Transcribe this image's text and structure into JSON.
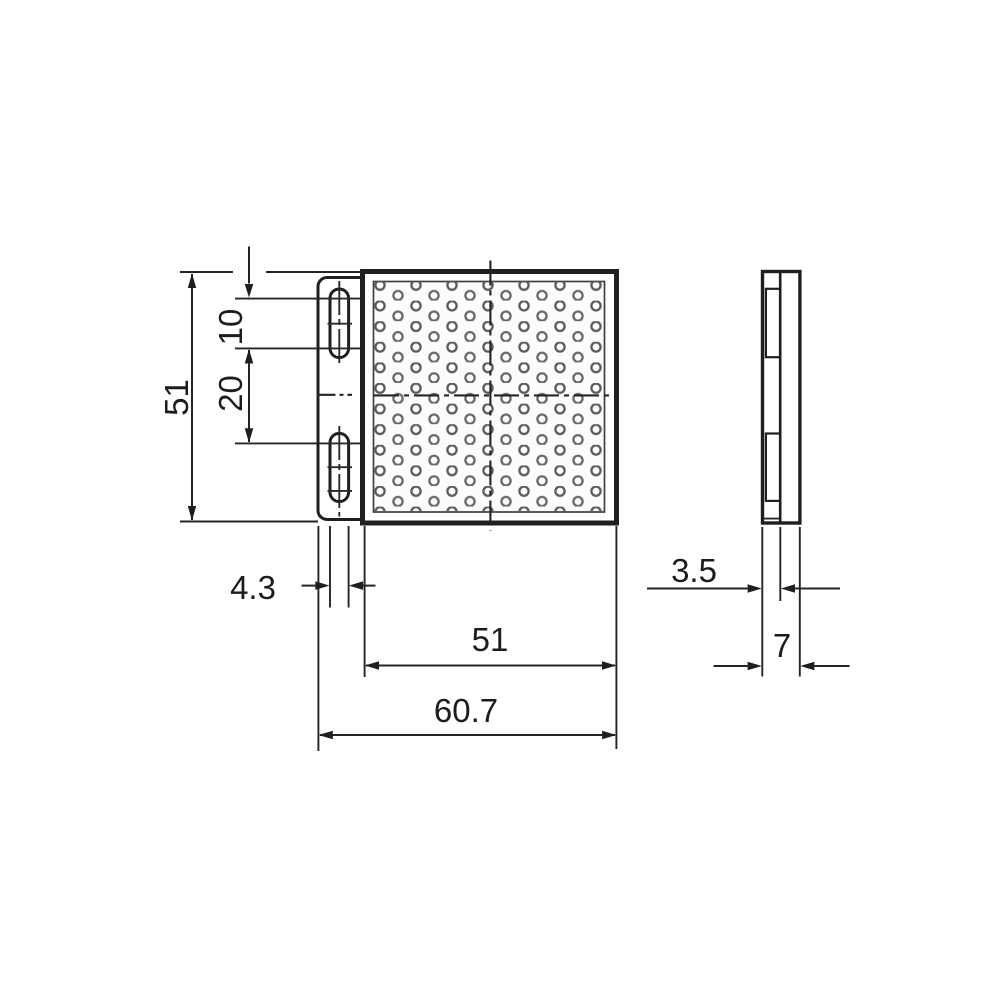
{
  "drawing": {
    "kind": "technical-dimension-drawing",
    "views": {
      "front": "front-view-reflector-with-bracket",
      "side": "side-profile-view"
    }
  },
  "dims": {
    "overall_height": "51",
    "slot_length": "10",
    "slot_pitch": "20",
    "slot_width": "4.3",
    "reflector_width": "51",
    "overall_width": "60.7",
    "bracket_thickness": "3.5",
    "overall_depth": "7"
  },
  "colors": {
    "background": "#ffffff",
    "line": "#1f1f1f",
    "pattern_ring": "#5c5c5c",
    "face_fill": "#fcfcfc"
  }
}
